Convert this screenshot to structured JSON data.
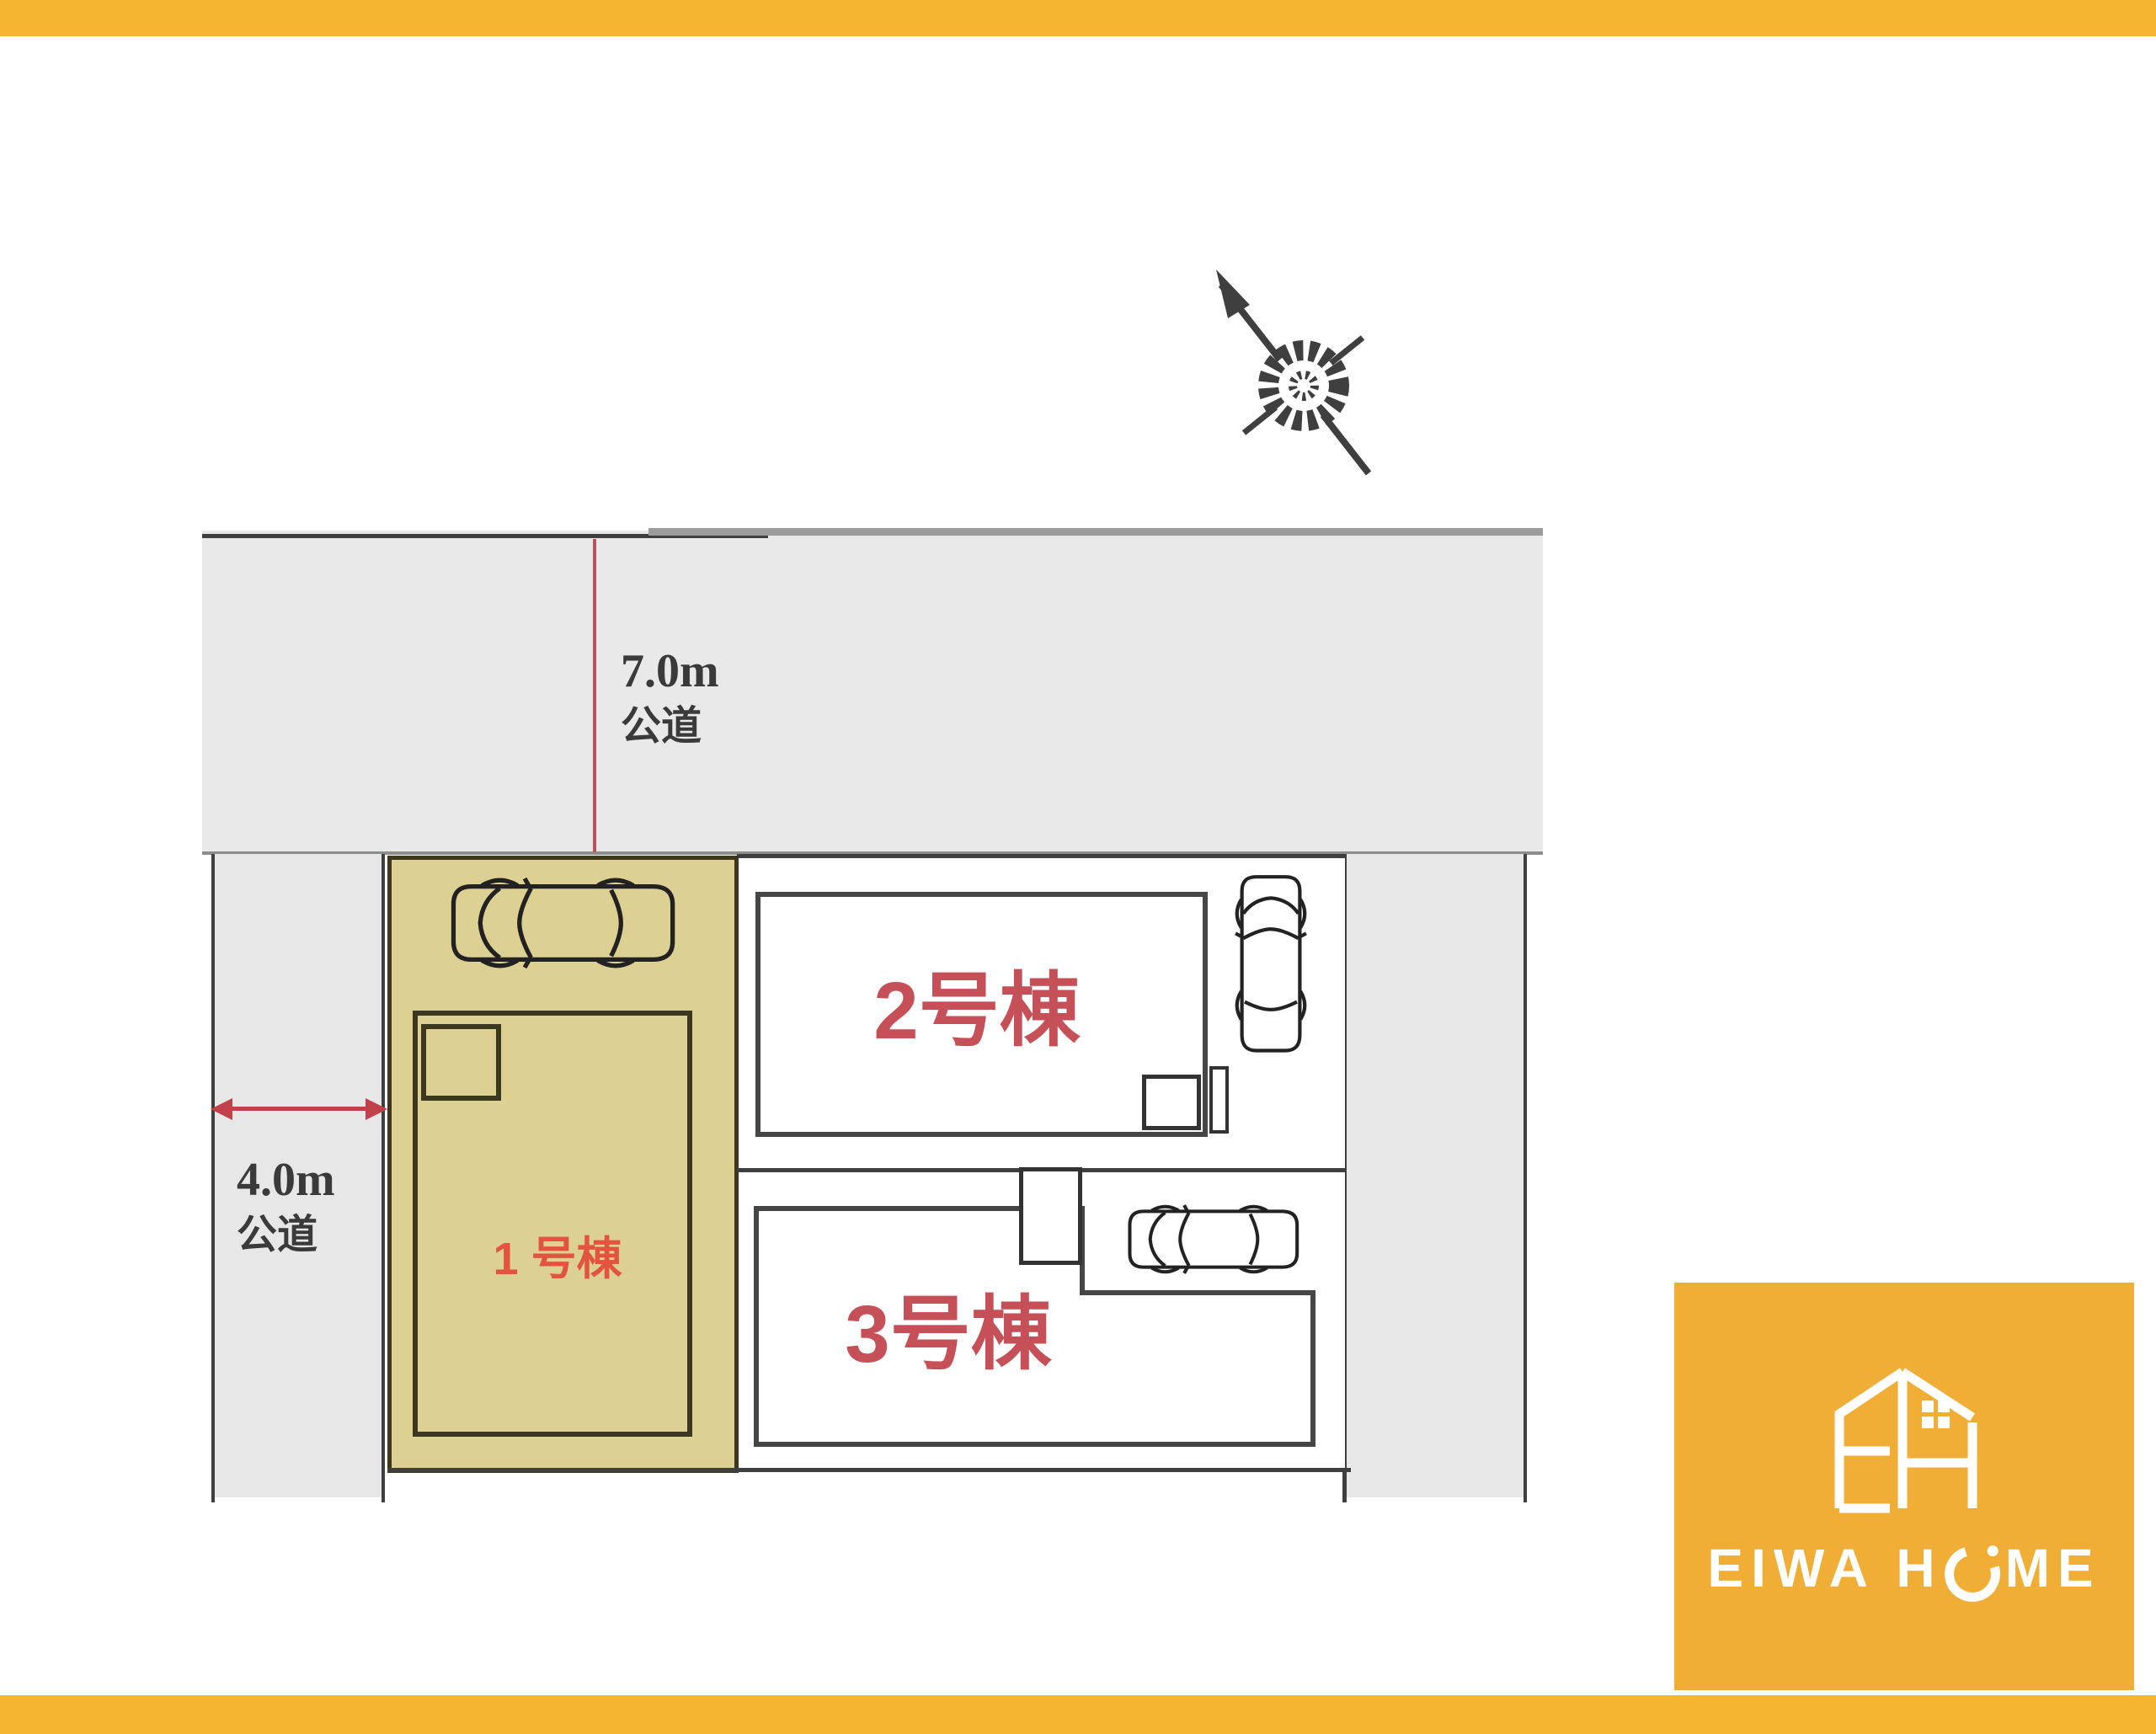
{
  "meta": {
    "description_label": "分譲区画図"
  },
  "colors": {
    "accent_orange": "#f5b52f",
    "logo_orange": "#f0ae36",
    "road_fill": "#e9e9e9",
    "road_line_dark": "#3f3f3f",
    "road_line_gray": "#9b9b9b",
    "lot_fill_tan": "#dcd192",
    "lot_border": "#3c3820",
    "dimension_red": "#c04149",
    "lot1_label_red": "#e25440",
    "lot23_label_red": "#c55057",
    "road_text_dark": "#3a3a3a",
    "logo_text_white": "#ffffff"
  },
  "roads": {
    "top": {
      "width_label": "7.0m",
      "type_label": "公道"
    },
    "left": {
      "width_label": "4.0m",
      "type_label": "公道"
    }
  },
  "lots": [
    {
      "id": "lot-1",
      "label": "1 号棟"
    },
    {
      "id": "lot-2",
      "label": "2号棟"
    },
    {
      "id": "lot-3",
      "label": "3号棟"
    }
  ],
  "logo": {
    "text_before_o": "EIWA H",
    "text_after_o": "ME"
  }
}
